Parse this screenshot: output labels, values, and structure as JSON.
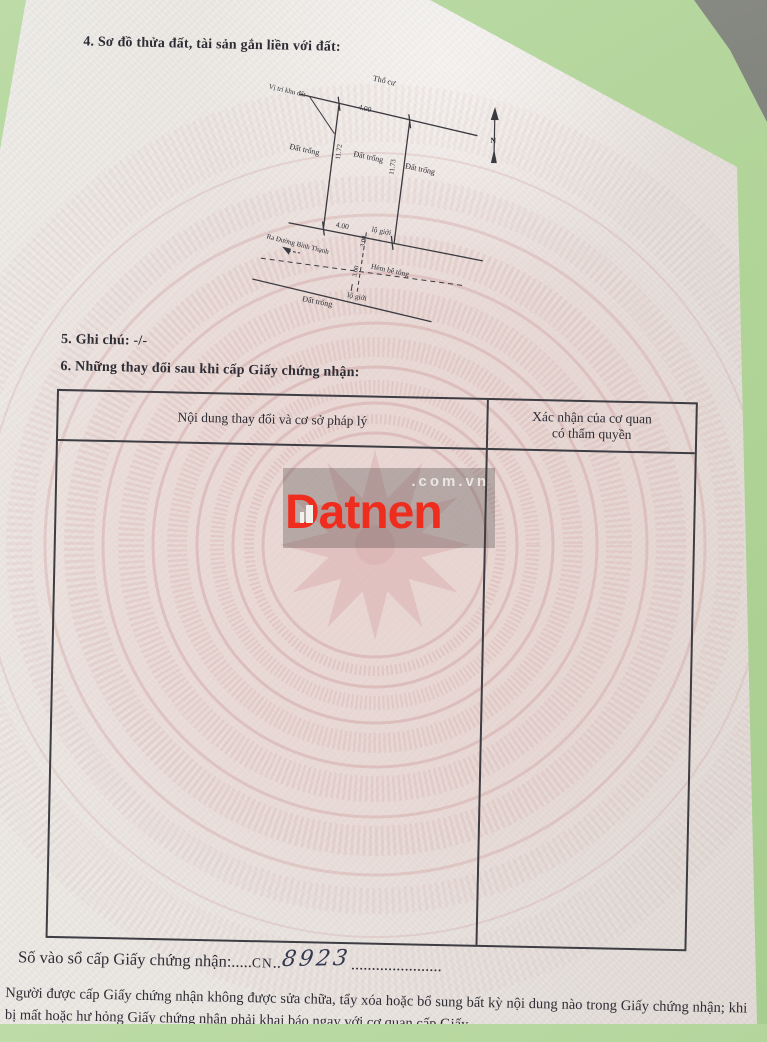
{
  "document": {
    "section4_title": "4. Sơ đồ thửa đất, tài sản gắn liền với đất:",
    "section5_line": "5. Ghi chú: -/-",
    "section6_title": "6. Những thay đổi sau khi cấp Giấy chứng nhận:"
  },
  "diagram": {
    "land_use_top": "Thổ cư",
    "location_label": "Vị trí khu đất",
    "vacant_land": "Đất trống",
    "top_length": "4.00",
    "left_length": "11.72",
    "right_length": "11.73",
    "bottom_length": "4.00",
    "alley_width_1": "3.00",
    "alley_width_2": "3.00",
    "road_boundary": "lộ giới",
    "street_direction": "Ra Đường Bình Thạnh",
    "alley_name": "Hẻm bê tông",
    "north_mark": "N"
  },
  "table": {
    "header_left": "Nội dung thay đổi và cơ sở pháp lý",
    "header_right_line1": "Xác nhận của cơ quan",
    "header_right_line2": "có thẩm quyền"
  },
  "watermark": {
    "brand": "Datnen",
    "suffix": ".com.vn"
  },
  "footer": {
    "register_label": "Số vào sổ cấp Giấy chứng nhận:",
    "dots_before": ".....",
    "register_code": "CN",
    "dots_mid": "..",
    "register_number": "8923",
    "dots_after": "......................",
    "note_line1": "Người được cấp Giấy chứng nhận không được sửa chữa, tẩy xóa hoặc bổ sung bất kỳ nội dung nào trong",
    "note_line2": "Giấy chứng nhận; khi bị mất hoặc hư hỏng Giấy chứng nhận phải khai báo ngay với cơ quan cấp Giấy"
  },
  "colors": {
    "background_green": "#b1d499",
    "logo_red": "#ee2d1f"
  }
}
